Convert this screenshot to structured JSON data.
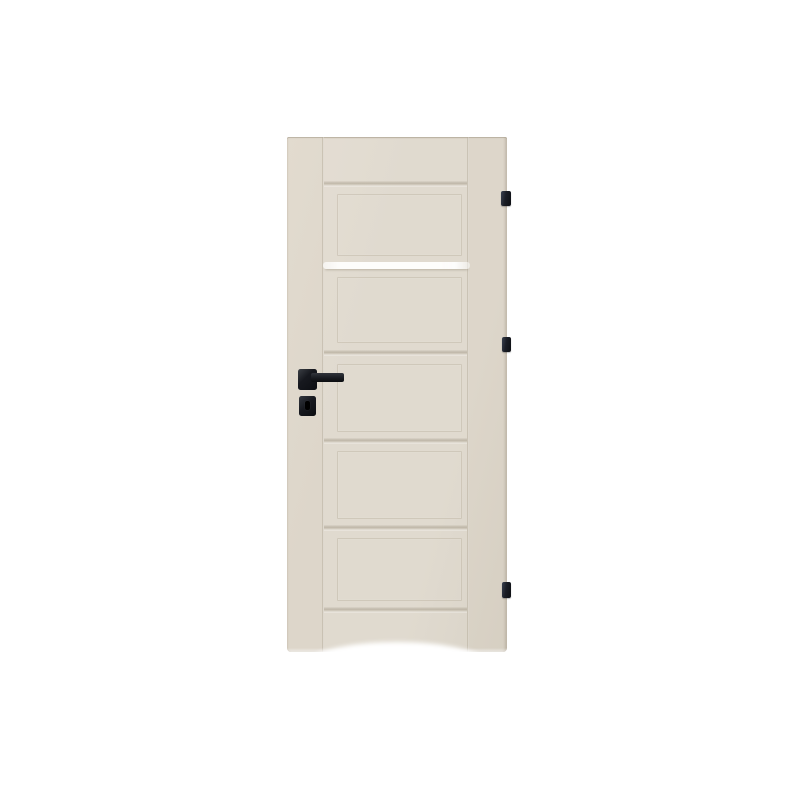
{
  "image": {
    "type": "product photo",
    "subject": "interior-door",
    "description": "Cream interior door with five recessed panels, a narrow frosted glass stripe in the upper third, a black square lever handle with separate key escutcheon, and three black hinges on the right edge; soft arched shadow fade at the bottom on a plain white background."
  },
  "door": {
    "finish": "cream",
    "panel_count": 5,
    "glass_stripe_count": 1,
    "hinge_count": 3,
    "hinge_side": "right",
    "handle": "black square lever",
    "escutcheon": "black square key plate"
  },
  "colors": {
    "background": "#ffffff",
    "door_face": "#ddd6ca",
    "door_face_light": "#e2dbcf",
    "door_face_dark": "#d6cfc2",
    "groove_shadow": "#cbc4b7",
    "glass_stripe": "#fdfdfb",
    "hardware_black": "#17191f",
    "hinge_black": "#1a1d25"
  }
}
